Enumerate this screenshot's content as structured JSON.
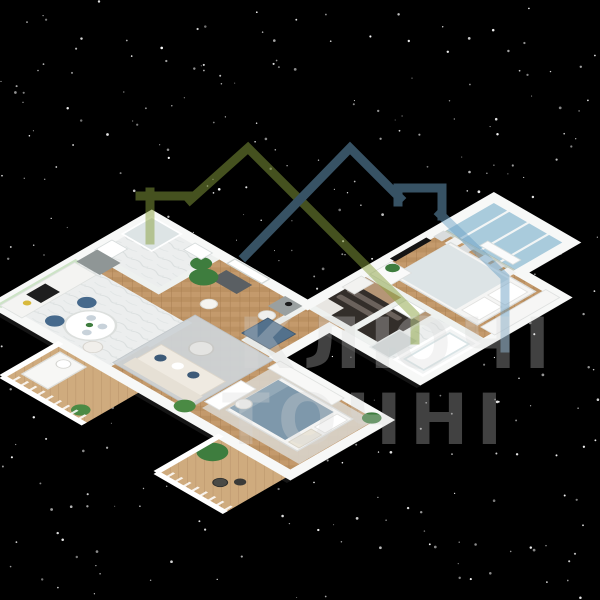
{
  "scene": {
    "kind": "isometric-3d-floor-plan-render",
    "description": "L-shaped one-level apartment 3D floor plan on black starry background"
  },
  "background": {
    "color": "#000000",
    "stars": {
      "count": 330,
      "color": "#ffffff"
    }
  },
  "watermark": {
    "text_line1": "КЛЮЧІ",
    "text_line2": "ТОЧНІ",
    "text_color": "#d8d8d8",
    "logo": {
      "left_house_color": "#8aa23f",
      "right_house_color": "#6fa3c7"
    }
  },
  "palette": {
    "outer_wall": "#f7f8f7",
    "inner_wall": "#eef1ef",
    "sage_wall_tint": "#c6d4cc",
    "wood_floor": "#c49a6c",
    "wood_floor_light": "#cfab7e",
    "marble_floor": "#eceeee",
    "rug_gray": "#ced3d6",
    "rug_beige": "#d9d4cb",
    "sofa_cream": "#efeae1",
    "armchair_slate_blue": "#53718c",
    "bed_blanket_blue": "#7e98ab",
    "closet_dark": "#332e2a",
    "closet_wood": "#b59676",
    "glazing_blue": "#a9cbdc",
    "plant_green": "#3e7d3e",
    "tv_black": "#141414"
  },
  "apartment": {
    "rooms": [
      {
        "id": "kitchen-dining",
        "name": "kitchen-dining"
      },
      {
        "id": "living-room",
        "name": "living-room"
      },
      {
        "id": "entry-hall",
        "name": "entry-hall"
      },
      {
        "id": "bathroom-small",
        "name": "small-bathroom"
      },
      {
        "id": "walk-in-closet",
        "name": "walk-in-closet"
      },
      {
        "id": "corridor",
        "name": "corridor"
      },
      {
        "id": "bedroom-1",
        "name": "bedroom-main"
      },
      {
        "id": "balcony-glazed",
        "name": "glazed-balcony"
      },
      {
        "id": "bathroom-main",
        "name": "main-bathroom"
      },
      {
        "id": "bedroom-2",
        "name": "bedroom-second"
      },
      {
        "id": "balcony-left",
        "name": "left-balcony"
      },
      {
        "id": "balcony-bottom",
        "name": "bottom-balcony"
      }
    ],
    "furniture": [
      "kitchen-counter",
      "cooktop",
      "tall-cabinet",
      "dining-table",
      "dining-chairs",
      "sofa",
      "armchair",
      "coffee-table",
      "floor-lamp",
      "potted-plants",
      "area-rug",
      "front-door",
      "doormat",
      "console-table",
      "pouf",
      "shower",
      "toilet",
      "washbasin",
      "wardrobe-shelves",
      "bed",
      "tv",
      "dresser",
      "curtains",
      "radiator",
      "bathtub",
      "shower-tray",
      "desk",
      "desk-chair",
      "wardrobe",
      "lounge-chair",
      "bistro-set",
      "balcony-railing"
    ]
  }
}
